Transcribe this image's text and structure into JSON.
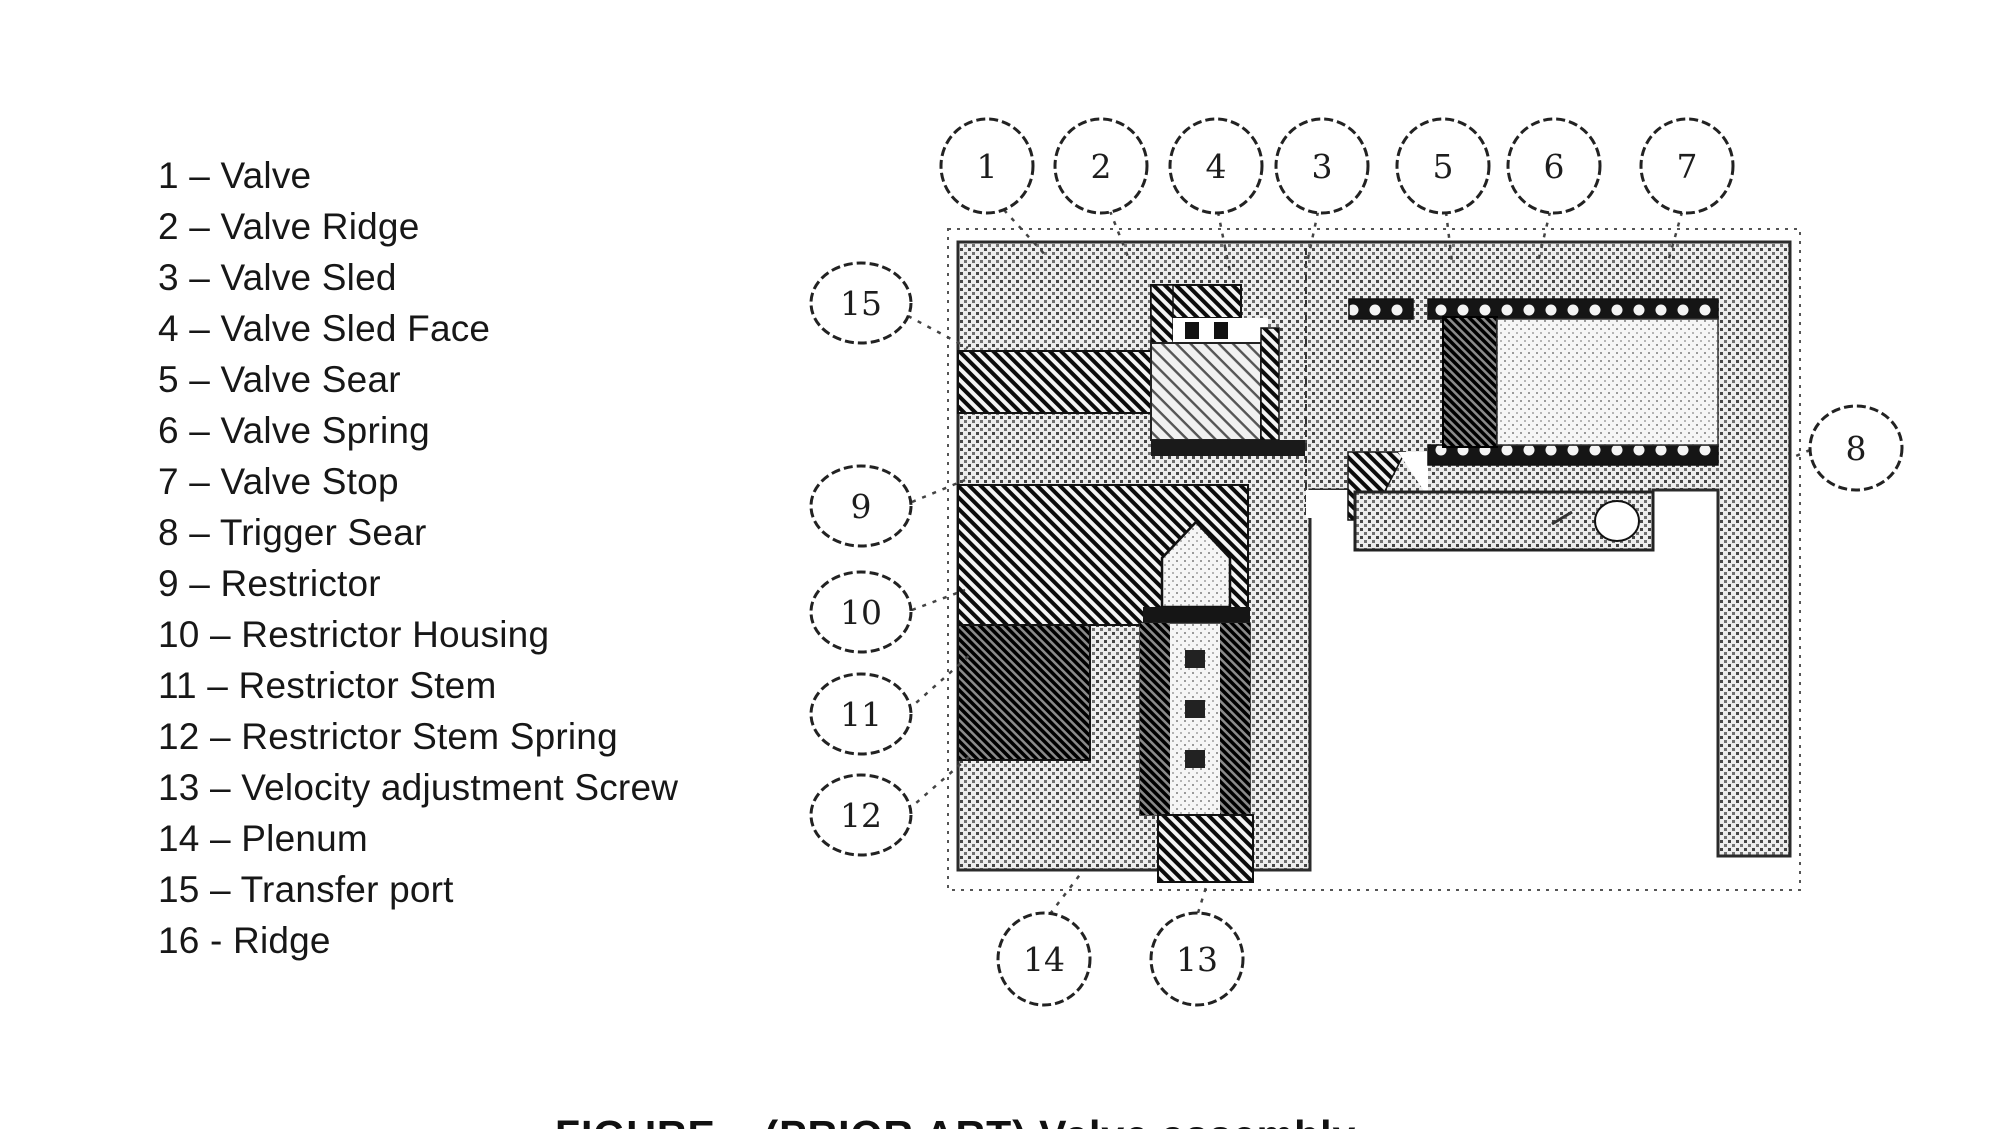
{
  "figure": {
    "caption": "FIGURE – (PRIOR ART) Valve assembly",
    "legend": {
      "items": [
        "1 – Valve",
        "2 – Valve Ridge",
        "3 – Valve Sled",
        "4 – Valve Sled Face",
        "5 – Valve Sear",
        "6 – Valve Spring",
        "7 – Valve Stop",
        "8 – Trigger Sear",
        "9 – Restrictor",
        "10 – Restrictor Housing",
        "11 – Restrictor Stem",
        "12 – Restrictor Stem Spring",
        "13 – Velocity adjustment Screw",
        "14 – Plenum",
        "15 – Transfer port",
        "16 - Ridge"
      ]
    },
    "callouts": {
      "top": [
        "1",
        "2",
        "4",
        "3",
        "5",
        "6",
        "7"
      ],
      "left": [
        "15",
        "9",
        "10",
        "11",
        "12"
      ],
      "right": [
        "8"
      ],
      "bottom": [
        "14",
        "13"
      ]
    }
  },
  "colors": {
    "ink": "#1a1a1a",
    "paper": "#ffffff"
  }
}
